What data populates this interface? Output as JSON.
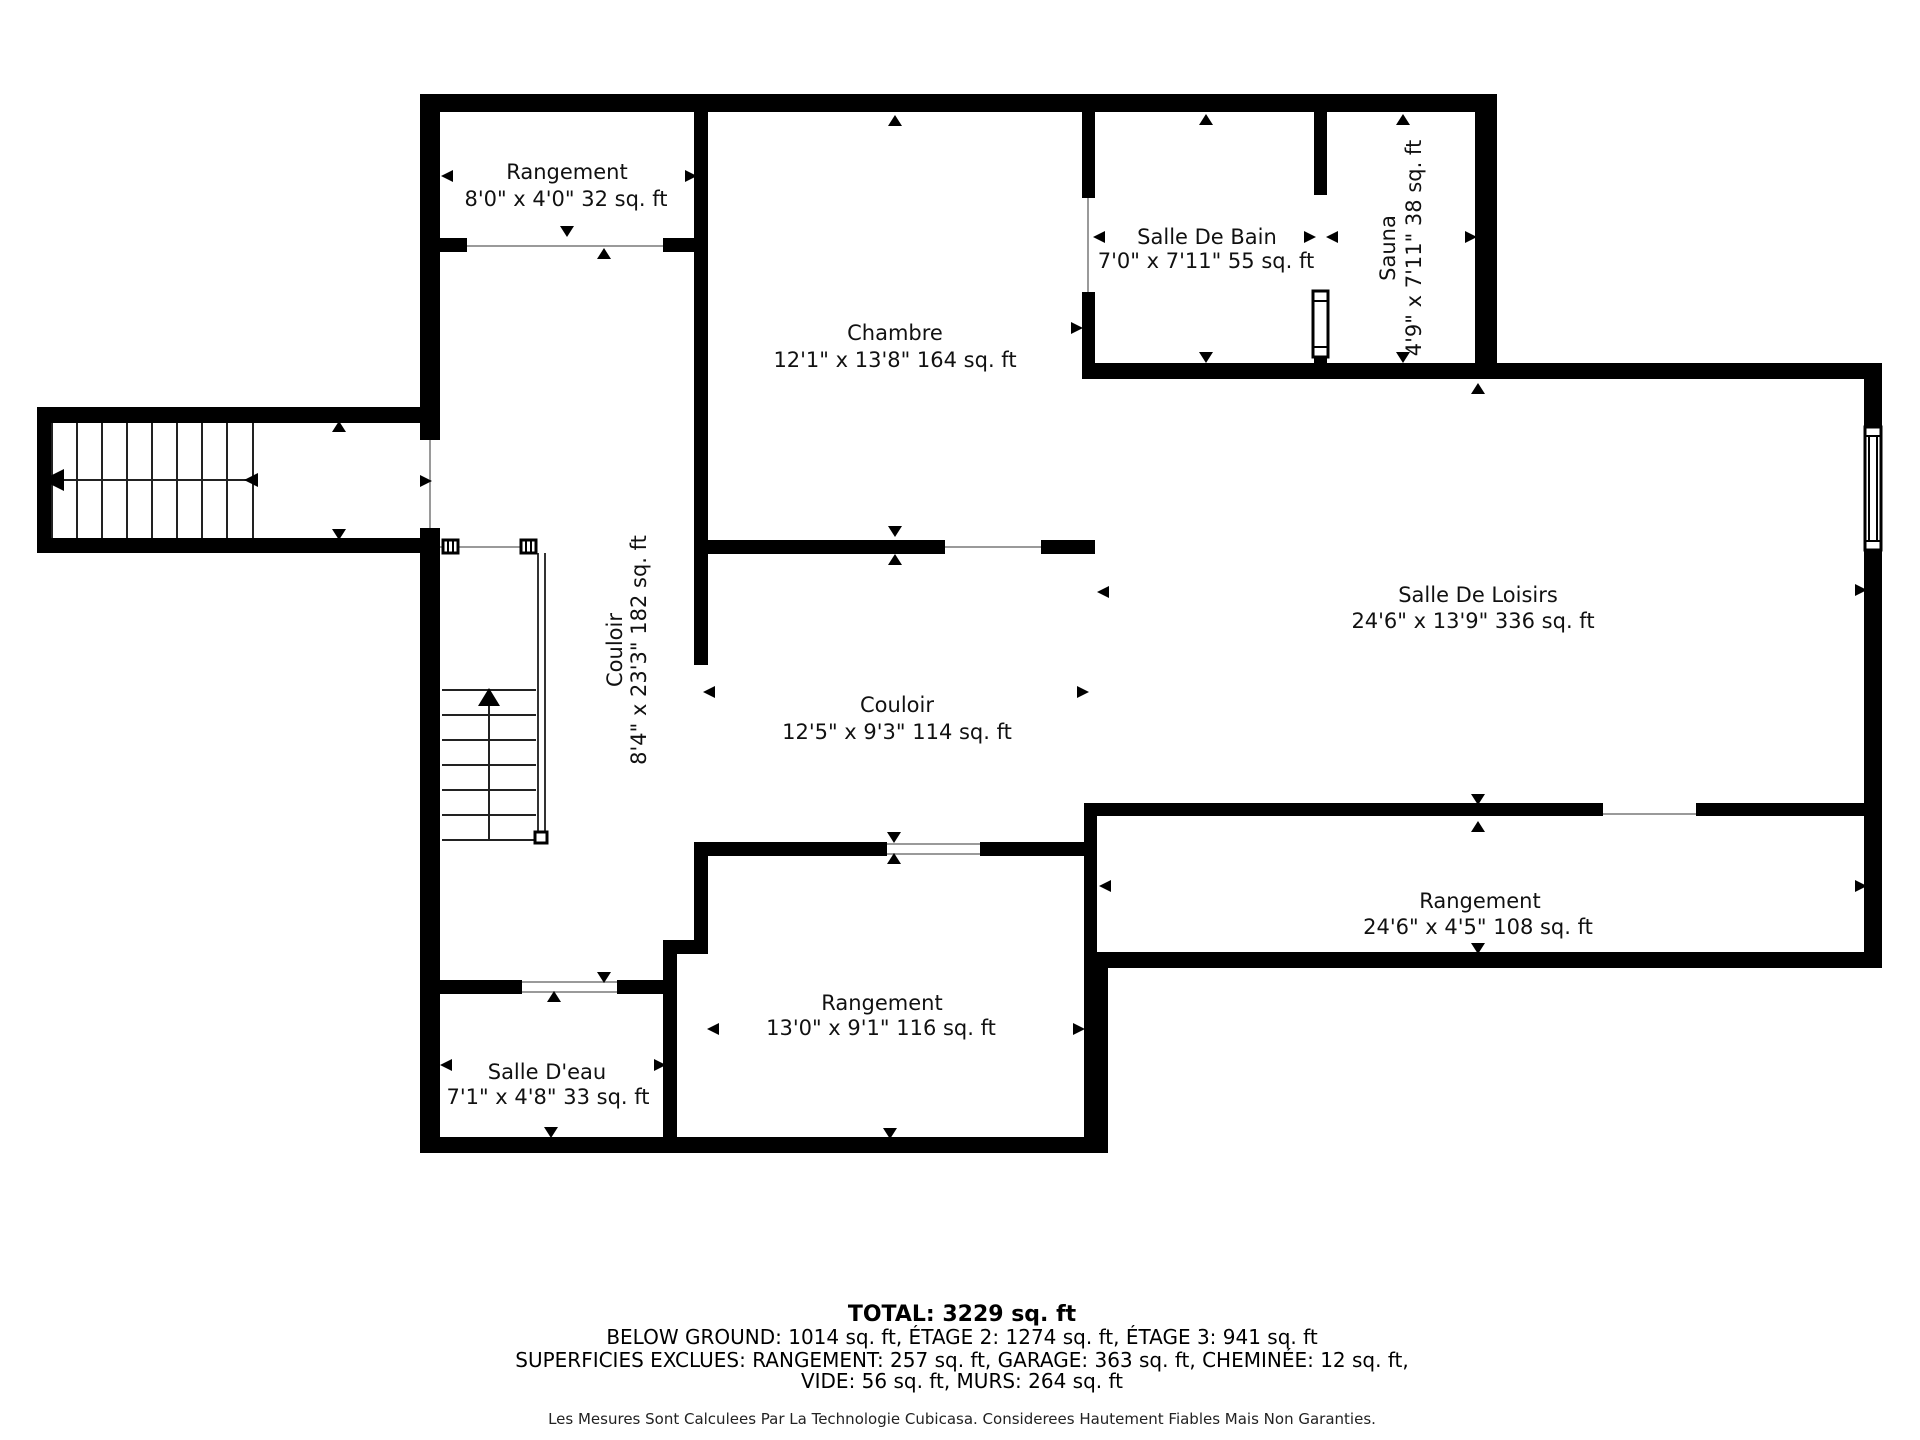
{
  "plan": {
    "type": "floor-plan",
    "language": "fr",
    "colors": {
      "wall": "#000000",
      "background": "#ffffff",
      "text": "#111111",
      "opening_line": "#9a9a9a"
    },
    "rooms": [
      {
        "id": "rangement-nw",
        "name": "Rangement",
        "dims": "8'0\" x 4'0\" 32 sq. ft"
      },
      {
        "id": "chambre",
        "name": "Chambre",
        "dims": "12'1\" x 13'8\" 164 sq. ft"
      },
      {
        "id": "salle-de-bain",
        "name": "Salle De Bain",
        "dims": "7'0\" x 7'11\" 55 sq. ft"
      },
      {
        "id": "sauna",
        "name": "Sauna",
        "dims": "4'9\" x 7'11\" 38 sq. ft"
      },
      {
        "id": "couloir-ouest",
        "name": "Couloir",
        "dims": "8'4\" x 23'3\" 182 sq. ft"
      },
      {
        "id": "couloir-central",
        "name": "Couloir",
        "dims": "12'5\" x 9'3\" 114 sq. ft"
      },
      {
        "id": "salle-de-loisirs",
        "name": "Salle De Loisirs",
        "dims": "24'6\" x 13'9\" 336 sq. ft"
      },
      {
        "id": "rangement-est",
        "name": "Rangement",
        "dims": "24'6\" x 4'5\" 108 sq. ft"
      },
      {
        "id": "rangement-sud",
        "name": "Rangement",
        "dims": "13'0\" x 9'1\" 116 sq. ft"
      },
      {
        "id": "salle-deau",
        "name": "Salle D'eau",
        "dims": "7'1\" x 4'8\" 33 sq. ft"
      }
    ],
    "footer": {
      "total": "TOTAL: 3229 sq. ft",
      "floors": "BELOW GROUND: 1014 sq. ft, ÉTAGE 2: 1274 sq. ft, ÉTAGE 3: 941 sq. ft",
      "excluded_1": "SUPERFICIES EXCLUES: RANGEMENT: 257 sq. ft, GARAGE: 363 sq. ft, CHEMINÉE: 12 sq. ft,",
      "excluded_2": "VIDE: 56 sq. ft, MURS: 264 sq. ft",
      "disclaimer": "Les Mesures Sont Calculees Par La Technologie Cubicasa. Considerees Hautement Fiables Mais Non Garanties."
    }
  }
}
